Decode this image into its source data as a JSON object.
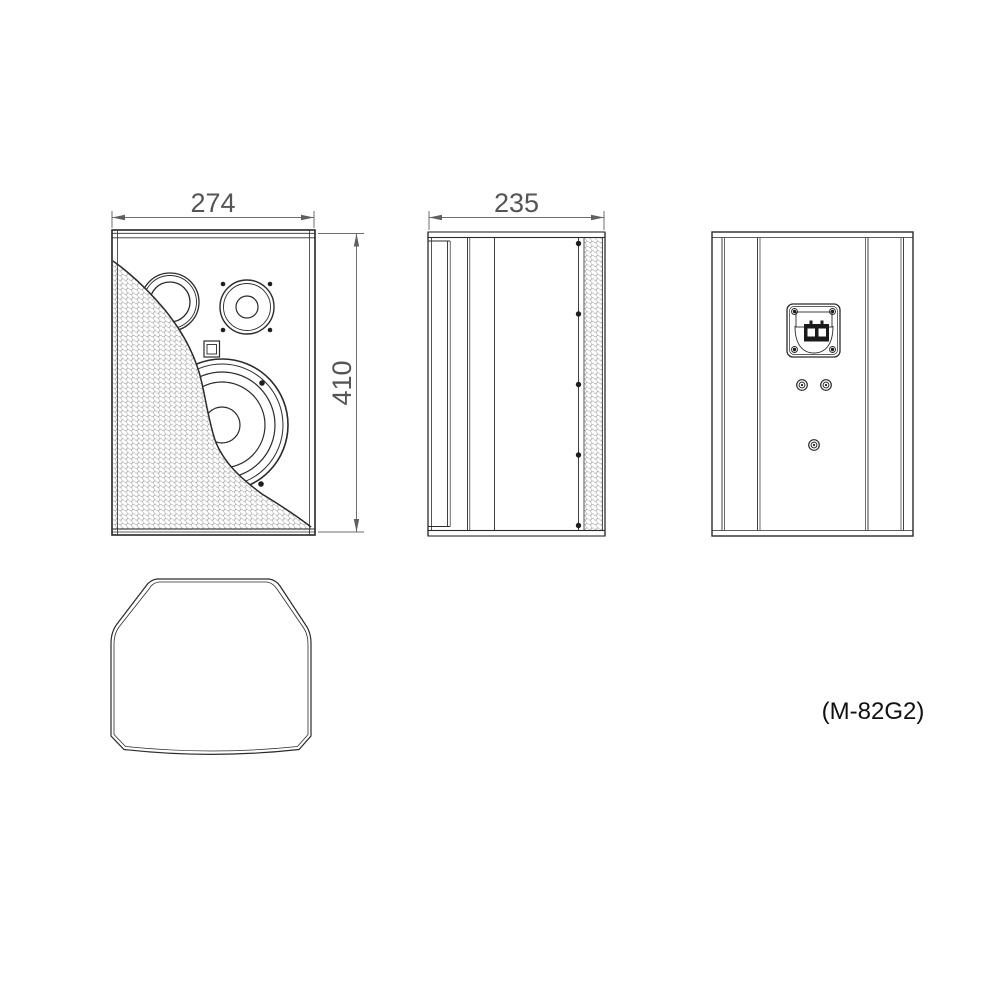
{
  "drawing": {
    "model_label": "(M-82G2)",
    "dim_front_width": "274",
    "dim_side_depth": "235",
    "dim_height": "410"
  }
}
